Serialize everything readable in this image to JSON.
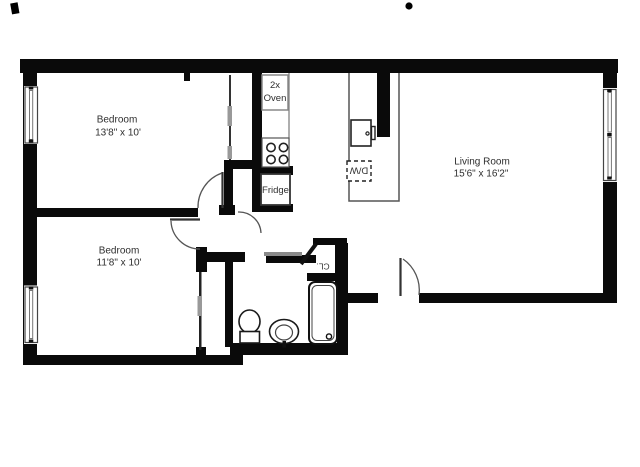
{
  "plan": {
    "rooms": {
      "bedroom1": {
        "name": "Bedroom",
        "dims": "13'8\" x 10'"
      },
      "bedroom2": {
        "name": "Bedroom",
        "dims": "11'8\" x 10'"
      },
      "living_room": {
        "name": "Living Room",
        "dims": "15'6\" x 16'2\""
      }
    },
    "kitchen": {
      "oven_line1": "2x",
      "oven_line2": "Oven",
      "fridge_label": "Fridge",
      "dishwasher_label": "D/W"
    },
    "closet": {
      "label": "CL."
    },
    "colors": {
      "wall": "#0a0a0a",
      "text": "#2e2e2e",
      "fixture": "#1a1a1a",
      "light_gray": "#999999"
    }
  }
}
